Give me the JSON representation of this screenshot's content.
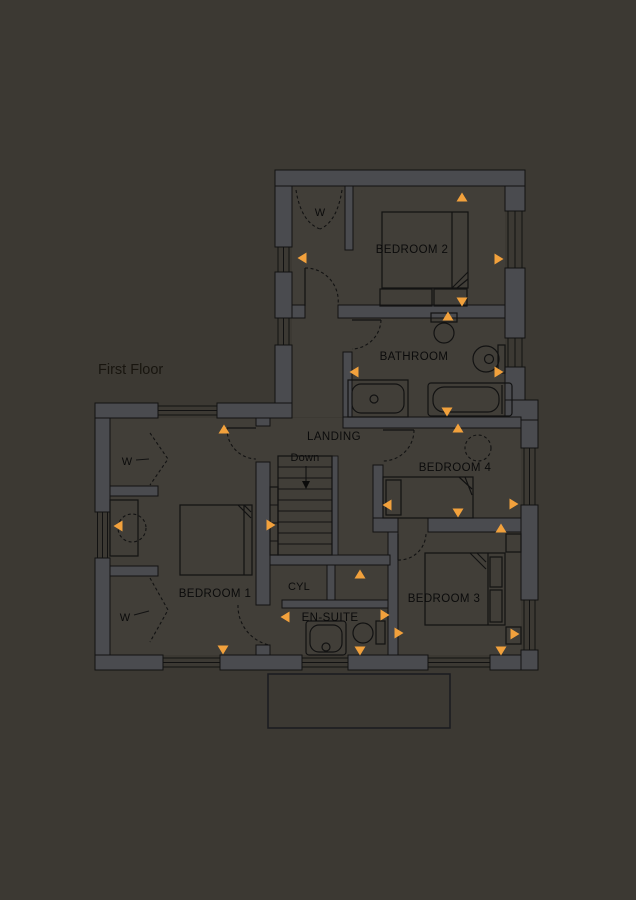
{
  "page": {
    "background_color": "#3C3933",
    "width": 636,
    "height": 900
  },
  "plan": {
    "floor_label": "First Floor",
    "colors": {
      "background": "#3C3933",
      "room_fill": "#413E38",
      "wall_fill": "#4A4B4F",
      "line": "#121212",
      "text": "#0B0B0B",
      "floor_label_text": "#18150F",
      "marker": "#F2A13C"
    },
    "labels": {
      "bedroom1": "BEDROOM 1",
      "bedroom2": "BEDROOM 2",
      "bedroom3": "BEDROOM 3",
      "bedroom4": "BEDROOM 4",
      "bathroom": "BATHROOM",
      "ensuite": "EN-SUITE",
      "landing": "LANDING",
      "cylinder": "CYL",
      "down": "Down",
      "wardrobe": "W"
    },
    "markers": [
      {
        "x": 462,
        "y": 197,
        "dir": "up"
      },
      {
        "x": 302,
        "y": 258,
        "dir": "left"
      },
      {
        "x": 499,
        "y": 259,
        "dir": "right"
      },
      {
        "x": 462,
        "y": 302,
        "dir": "down"
      },
      {
        "x": 448,
        "y": 316,
        "dir": "up"
      },
      {
        "x": 354,
        "y": 372,
        "dir": "left"
      },
      {
        "x": 499,
        "y": 372,
        "dir": "right"
      },
      {
        "x": 447,
        "y": 412,
        "dir": "down"
      },
      {
        "x": 458,
        "y": 428,
        "dir": "up"
      },
      {
        "x": 224,
        "y": 429,
        "dir": "up"
      },
      {
        "x": 271,
        "y": 525,
        "dir": "right"
      },
      {
        "x": 387,
        "y": 505,
        "dir": "left"
      },
      {
        "x": 458,
        "y": 513,
        "dir": "down"
      },
      {
        "x": 514,
        "y": 504,
        "dir": "right"
      },
      {
        "x": 501,
        "y": 528,
        "dir": "up"
      },
      {
        "x": 515,
        "y": 634,
        "dir": "right"
      },
      {
        "x": 501,
        "y": 651,
        "dir": "down"
      },
      {
        "x": 118,
        "y": 526,
        "dir": "left"
      },
      {
        "x": 223,
        "y": 650,
        "dir": "down"
      },
      {
        "x": 285,
        "y": 617,
        "dir": "left"
      },
      {
        "x": 385,
        "y": 615,
        "dir": "right"
      },
      {
        "x": 399,
        "y": 633,
        "dir": "right"
      },
      {
        "x": 360,
        "y": 651,
        "dir": "down"
      },
      {
        "x": 360,
        "y": 574,
        "dir": "up"
      }
    ]
  }
}
